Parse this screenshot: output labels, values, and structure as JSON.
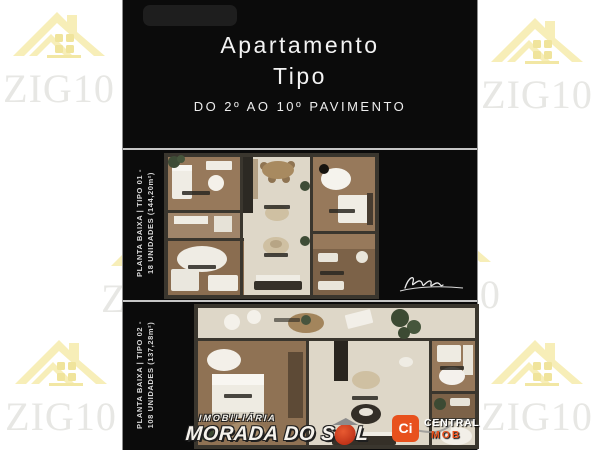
{
  "watermark": {
    "text": "ZIG10",
    "icon": "house-icon",
    "house_color": "#f7eeb8",
    "text_color": "#e7e7e4"
  },
  "header": {
    "title_line1": "Apartamento",
    "title_line2": "Tipo",
    "subtitle": "DO 2º AO 10º PAVIMENTO"
  },
  "plans": [
    {
      "label_line1": "PLANTA BAIXA | TIPO 01 -",
      "label_line2": "18 UNIDADES (144,20m²)"
    },
    {
      "label_line1": "PLANTA BAIXA | TIPO 02 -",
      "label_line2": "108 UNIDADES (137,28m²)"
    }
  ],
  "branding": {
    "agency": {
      "line1": "IMOBILIÁRIA",
      "line2_left": "MORADA DO S",
      "line2_right": "L",
      "sun_color": "#d64128"
    },
    "partner": {
      "badge": "Ci",
      "line1": "CENTRAL",
      "line2": "MOB",
      "accent_color": "#e8511d"
    }
  },
  "colors": {
    "panel": "#0b0b0b",
    "divider": "#c6c6c6",
    "page_background": "#ffffff"
  }
}
